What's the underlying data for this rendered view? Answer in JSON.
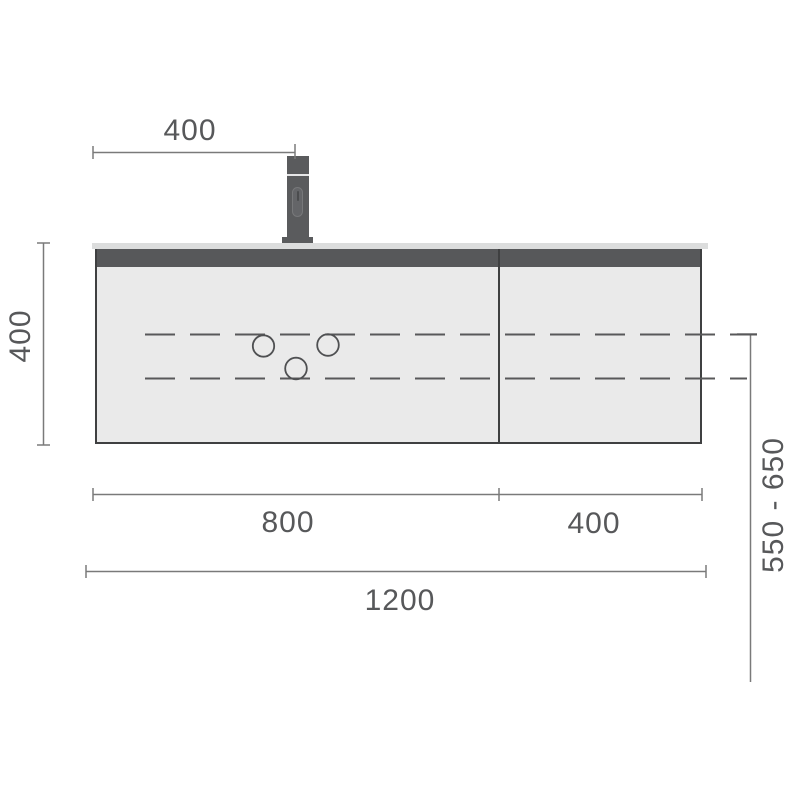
{
  "labels": {
    "faucet_offset": "400",
    "height": "400",
    "left_width": "800",
    "right_width": "400",
    "total_width": "1200",
    "height_range": "550 - 650"
  },
  "colors": {
    "outline": "#3f4041",
    "panel_fill": "#eaeaea",
    "front_band": "#57585a",
    "countertop": "#dcdddd",
    "faucet": "#5a5b5d",
    "dimension_line": "#7a7a7a",
    "dashed_line": "#58585a",
    "label_text": "#57585a",
    "background": "#ffffff"
  }
}
